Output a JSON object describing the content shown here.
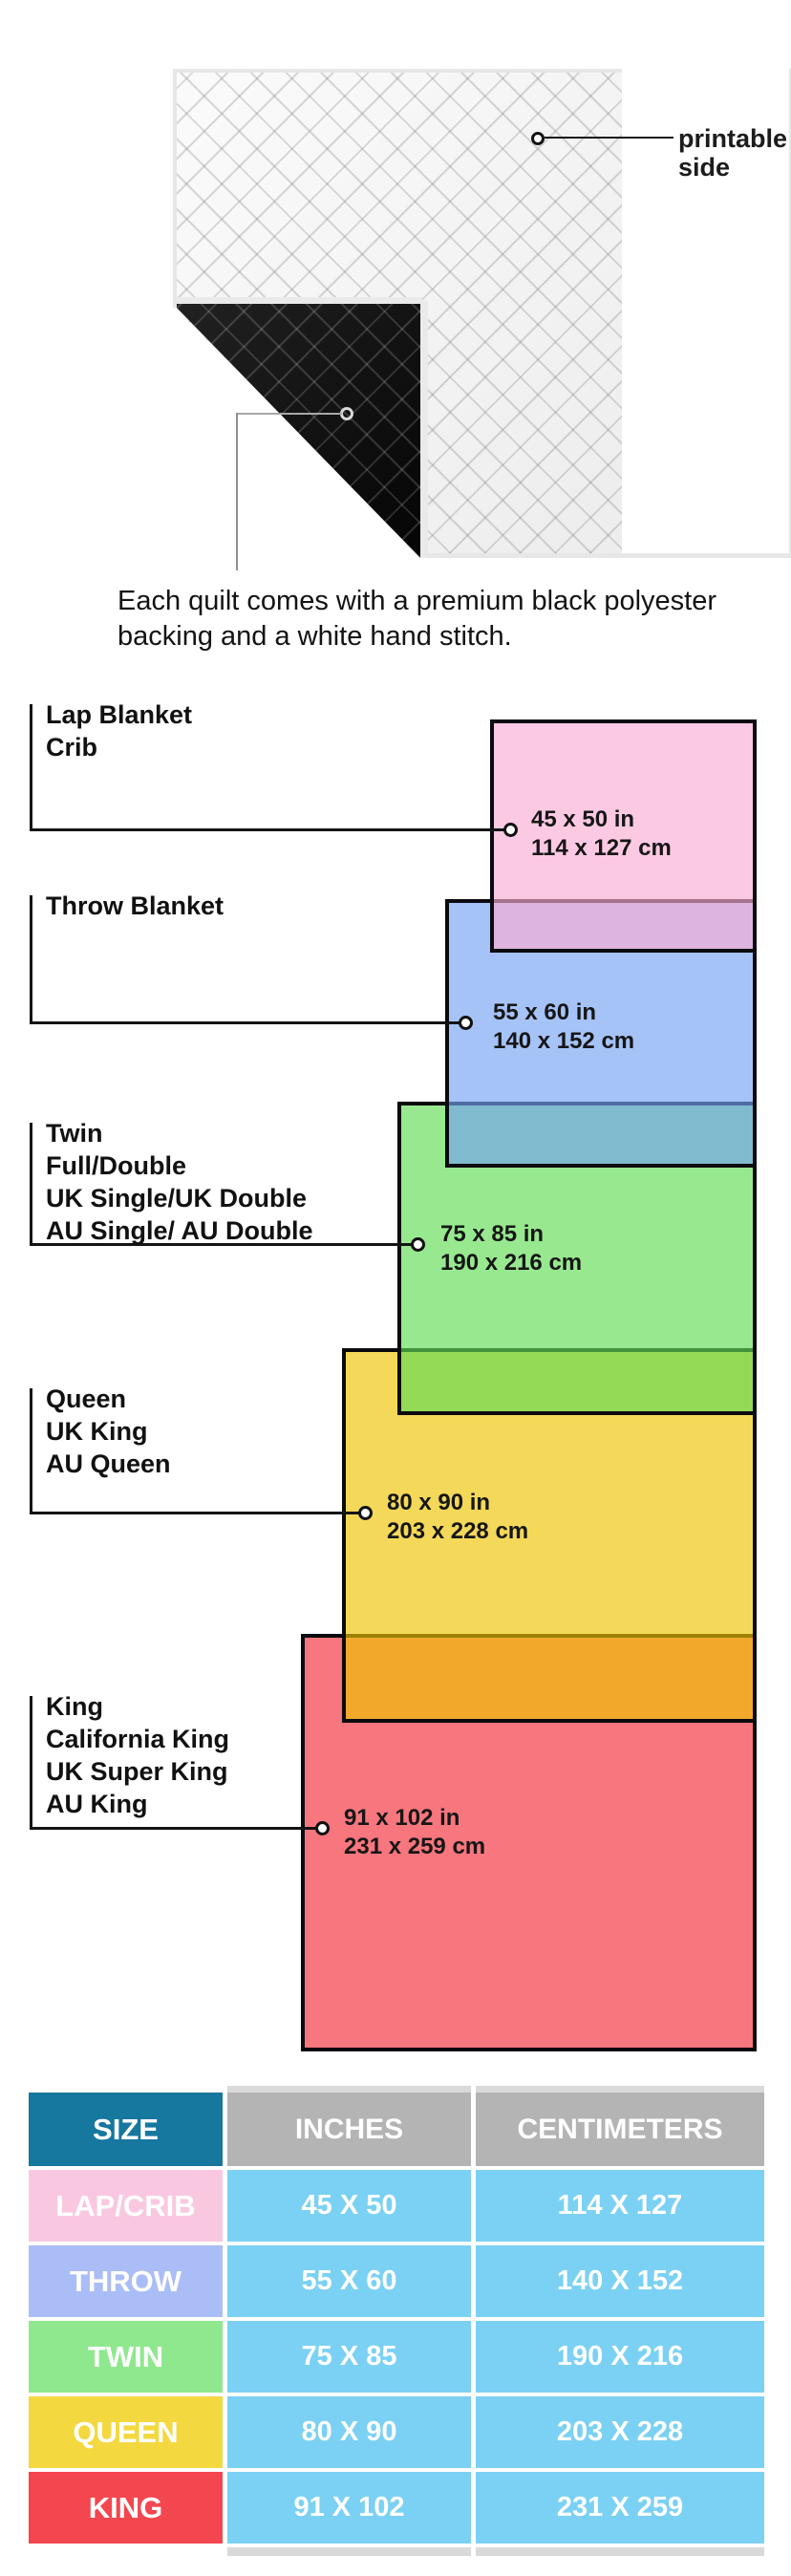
{
  "quilt": {
    "printable_label_line1": "printable",
    "printable_label_line2": "side",
    "caption_line1": "Each quilt comes with a premium black polyester",
    "caption_line2": "backing and a white hand stitch.",
    "front_color": "#f6f6f6",
    "backing_color": "#111111"
  },
  "diagram": {
    "sizes": [
      {
        "key": "lap",
        "label_lines": [
          "Lap Blanket",
          "Crib"
        ],
        "inches": "45 x 50 in",
        "centimeters": "114 x 127 cm",
        "fill": "rgba(250,172,212,0.65)",
        "swatch": "#fccae4"
      },
      {
        "key": "throw",
        "label_lines": [
          "Throw Blanket"
        ],
        "inches": "55 x 60 in",
        "centimeters": "140 x 152 cm",
        "fill": "rgba(117,163,243,0.65)",
        "swatch": "#a5c3f7"
      },
      {
        "key": "twin",
        "label_lines": [
          "Twin",
          "Full/Double",
          "UK Single/UK Double",
          "AU Single/ AU Double"
        ],
        "inches": "75 x 85 in",
        "centimeters": "190 x 216 cm",
        "fill": "rgba(97,220,85,0.65)",
        "swatch": "#98e890"
      },
      {
        "key": "queen",
        "label_lines": [
          "Queen",
          "UK King",
          "AU Queen"
        ],
        "inches": "80 x 90 in",
        "centimeters": "203 x 228 cm",
        "fill": "rgba(238,195,0,0.65)",
        "swatch": "#f4d844"
      },
      {
        "key": "king",
        "label_lines": [
          "King",
          "California King",
          "UK Super King",
          "AU King"
        ],
        "inches": "91 x 102 in",
        "centimeters": "231 x 259 cm",
        "fill": "rgba(245,45,55,0.65)",
        "swatch": "#f54850"
      }
    ]
  },
  "table": {
    "headers": [
      "SIZE",
      "INCHES",
      "CENTIMETERS"
    ],
    "header_colors": {
      "size_bg": "#16779f",
      "measure_bg": "#b4b4b4"
    },
    "cell_bg": "#7bd1f3",
    "rows": [
      {
        "size": "LAP/CRIB",
        "inches": "45 X 50",
        "centimeters": "114 X 127",
        "size_bg": "#f9c8e0"
      },
      {
        "size": "THROW",
        "inches": "55 X 60",
        "centimeters": "140 X 152",
        "size_bg": "#aabdf6"
      },
      {
        "size": "TWIN",
        "inches": "75 X 85",
        "centimeters": "190 X 216",
        "size_bg": "#90e88e"
      },
      {
        "size": "QUEEN",
        "inches": "80 X 90",
        "centimeters": "203 X 228",
        "size_bg": "#f4d840"
      },
      {
        "size": "KING",
        "inches": "91 X 102",
        "centimeters": "231 X 259",
        "size_bg": "#f4464f"
      }
    ]
  }
}
